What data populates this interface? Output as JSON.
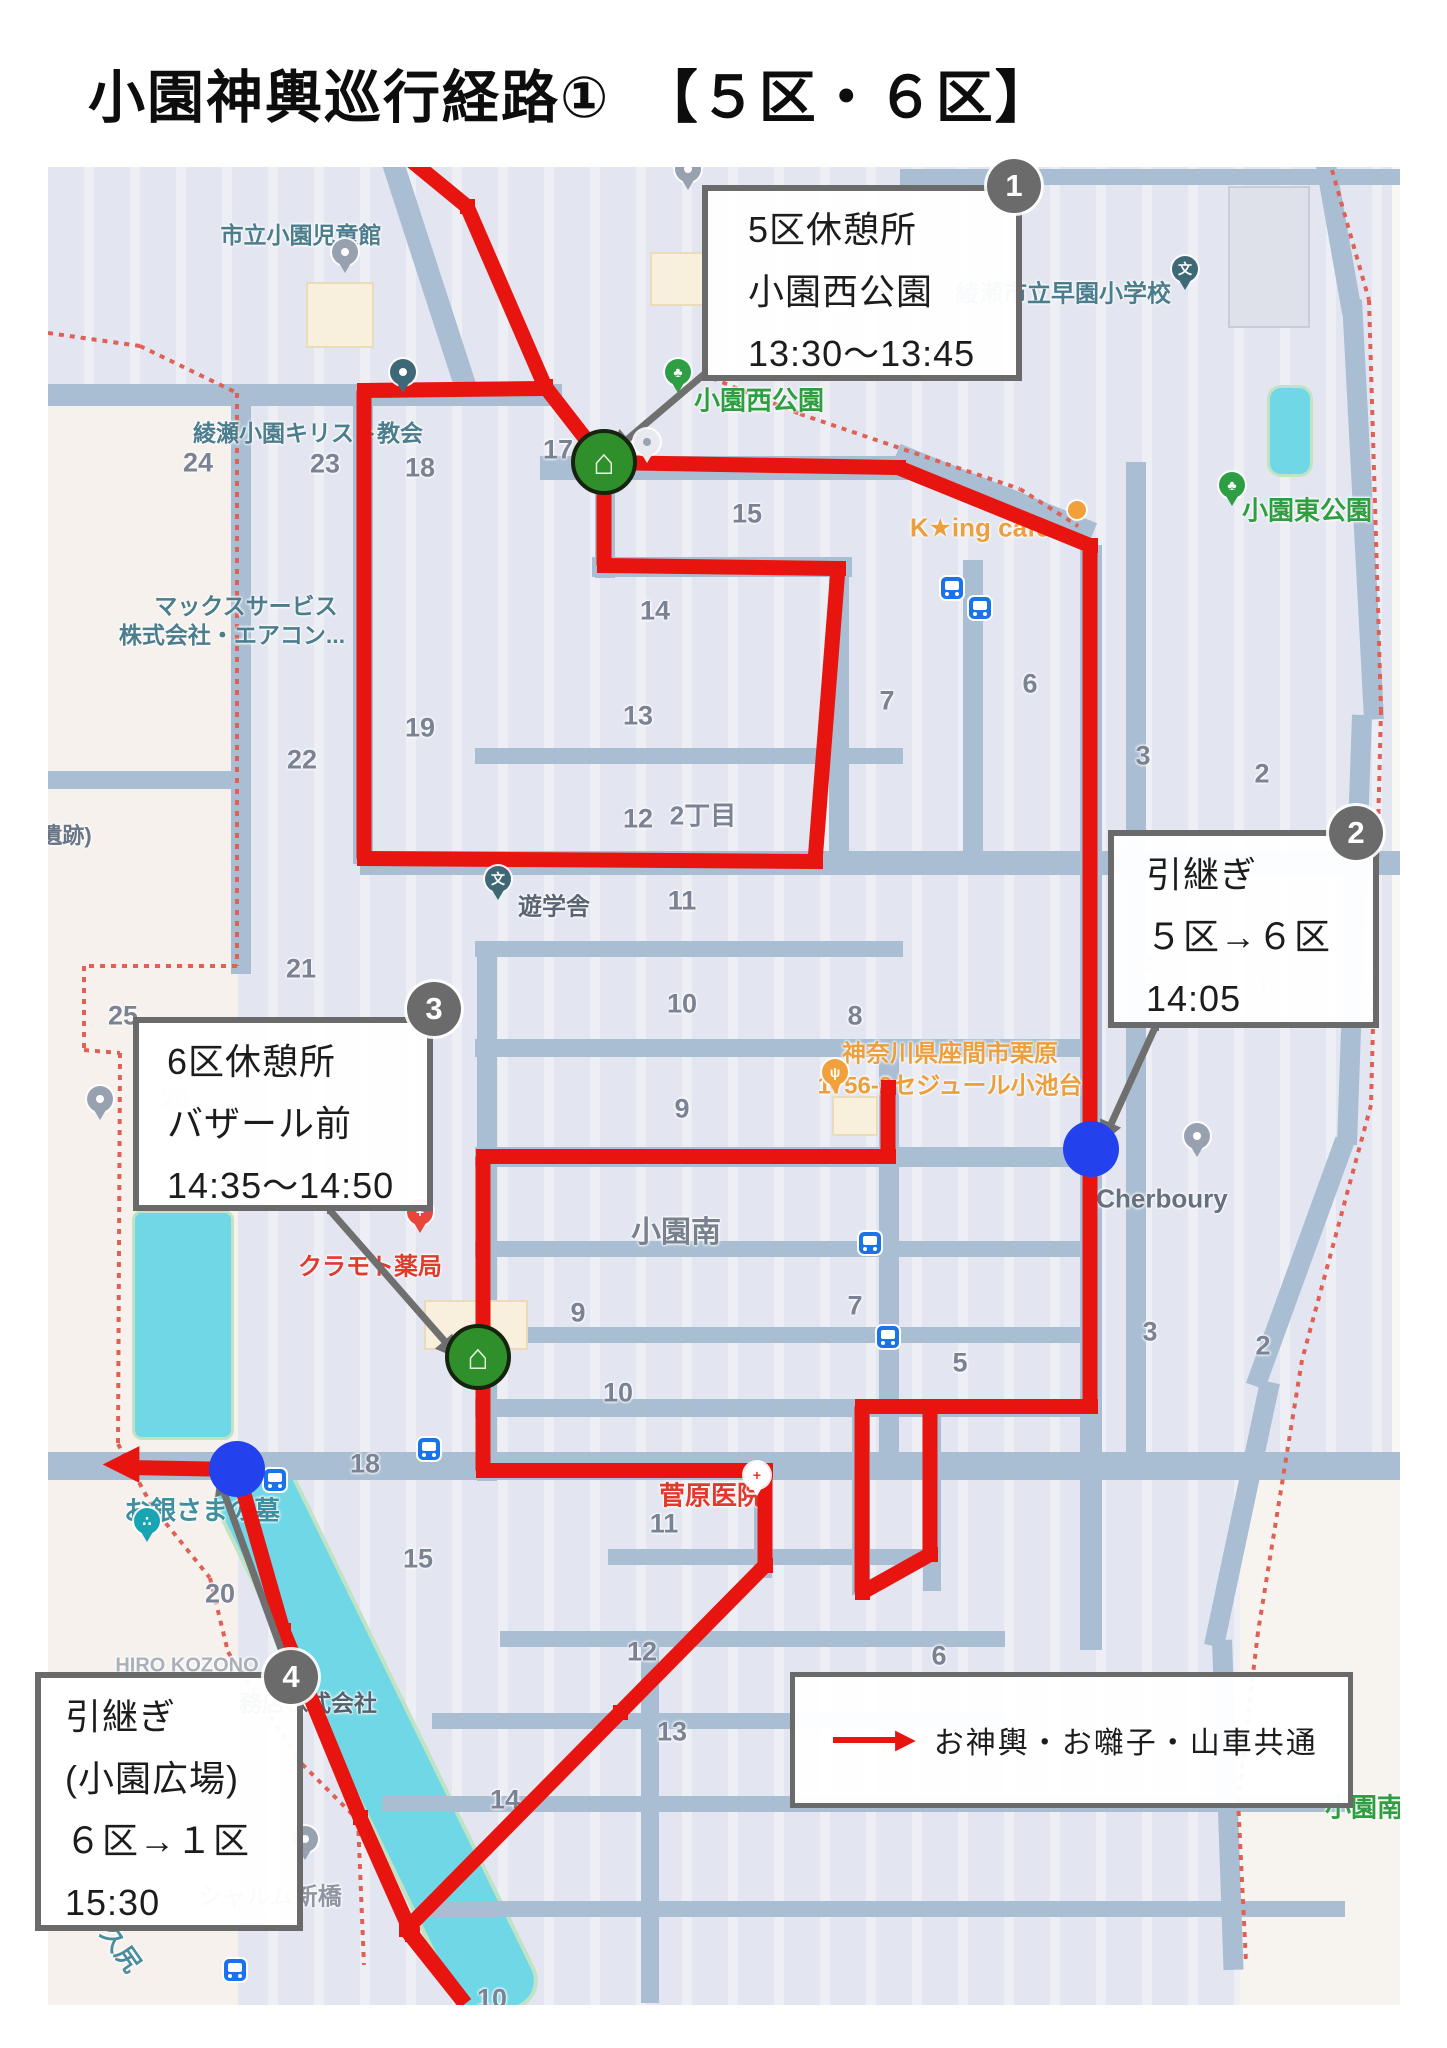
{
  "title": "小園神輿巡行経路①　【５区・６区】",
  "legend": {
    "x": 790,
    "y": 1672,
    "w": 553,
    "h": 126,
    "label": "お神輿・お囃子・山車共通",
    "arrow_color": "#e8140f"
  },
  "colors": {
    "route": "#e8140f",
    "road": "#a9bed3",
    "water": "#6fd7e6",
    "leader": "#6f6f6f",
    "badge": "#6b6b6b",
    "dot": "#2342ee",
    "house": "#2f8f2b",
    "boundary": "#e06055"
  },
  "info_boxes": [
    {
      "badge": "1",
      "x": 702,
      "y": 185,
      "w": 320,
      "h": 196,
      "bx": 1014,
      "by": 186,
      "pad": 40,
      "lines": [
        "5区休憩所",
        "小園西公園",
        "13:30〜13:45"
      ]
    },
    {
      "badge": "2",
      "x": 1108,
      "y": 830,
      "w": 271,
      "h": 198,
      "bx": 1356,
      "by": 833,
      "pad": 32,
      "lines": [
        "引継ぎ",
        "５区→６区",
        "14:05"
      ]
    },
    {
      "badge": "3",
      "x": 133,
      "y": 1017,
      "w": 300,
      "h": 194,
      "bx": 434,
      "by": 1009,
      "pad": 28,
      "lines": [
        "6区休憩所",
        "バザール前",
        "14:35〜14:50"
      ]
    },
    {
      "badge": "4",
      "x": 35,
      "y": 1672,
      "w": 268,
      "h": 259,
      "bx": 291,
      "by": 1677,
      "pad": 24,
      "lines": [
        "引継ぎ",
        "(小園広場)",
        "６区→１区",
        "15:30"
      ]
    }
  ],
  "map": {
    "x": 48,
    "y": 167,
    "w": 1352,
    "h": 1838
  },
  "tints": [
    {
      "x": 48,
      "y": 395,
      "w": 190,
      "h": 1610,
      "c": "#f6f1ed"
    },
    {
      "x": 1392,
      "y": 167,
      "w": 55,
      "h": 1295,
      "c": "#f9f7f4"
    },
    {
      "x": 1240,
      "y": 1462,
      "w": 207,
      "h": 543,
      "c": "#f7f4f0"
    }
  ],
  "water": [
    {
      "x": 132,
      "y": 1210,
      "w": 96,
      "h": 224,
      "r": 10
    },
    {
      "x": 1267,
      "y": 385,
      "w": 40,
      "h": 86,
      "r": 14
    }
  ],
  "river": {
    "x": 372,
    "y": 1736,
    "len": 600,
    "w": 78,
    "deg": 64
  },
  "roads_h": [
    [
      48,
      384,
      514,
      22
    ],
    [
      540,
      456,
      372,
      24
    ],
    [
      592,
      557,
      260,
      20
    ],
    [
      475,
      748,
      428,
      16
    ],
    [
      360,
      851,
      1087,
      24
    ],
    [
      475,
      941,
      428,
      16
    ],
    [
      475,
      1039,
      622,
      18
    ],
    [
      475,
      1147,
      622,
      20
    ],
    [
      475,
      1241,
      622,
      16
    ],
    [
      475,
      1327,
      622,
      16
    ],
    [
      475,
      1399,
      622,
      18
    ],
    [
      48,
      1452,
      1352,
      28
    ],
    [
      608,
      1549,
      330,
      16
    ],
    [
      500,
      1631,
      505,
      16
    ],
    [
      432,
      1713,
      573,
      16
    ],
    [
      382,
      1796,
      963,
      16
    ],
    [
      420,
      1901,
      925,
      16
    ],
    [
      48,
      771,
      190,
      18
    ],
    [
      900,
      169,
      500,
      16
    ]
  ],
  "roads_v": [
    [
      353,
      384,
      20,
      480
    ],
    [
      595,
      432,
      20,
      146
    ],
    [
      829,
      557,
      20,
      312
    ],
    [
      963,
      560,
      20,
      300
    ],
    [
      1080,
      545,
      22,
      1105
    ],
    [
      477,
      941,
      20,
      540
    ],
    [
      879,
      1041,
      20,
      412
    ],
    [
      852,
      1399,
      18,
      196
    ],
    [
      923,
      1399,
      18,
      192
    ],
    [
      754,
      1462,
      18,
      116
    ],
    [
      1126,
      462,
      20,
      1000
    ],
    [
      231,
      384,
      20,
      590
    ],
    [
      641,
      1631,
      18,
      372
    ]
  ],
  "roads_diag": [
    {
      "x": 388,
      "y": 148,
      "len": 260,
      "w": 22,
      "deg": 72
    },
    {
      "x": 896,
      "y": 455,
      "len": 212,
      "w": 24,
      "deg": 22
    },
    {
      "x": 1326,
      "y": 165,
      "len": 150,
      "w": 20,
      "deg": 80
    },
    {
      "x": 1352,
      "y": 300,
      "len": 420,
      "w": 20,
      "deg": 87
    },
    {
      "x": 1362,
      "y": 715,
      "len": 430,
      "w": 20,
      "deg": 92
    },
    {
      "x": 1345,
      "y": 1140,
      "len": 262,
      "w": 20,
      "deg": 110
    },
    {
      "x": 1270,
      "y": 1382,
      "len": 270,
      "w": 20,
      "deg": 102
    },
    {
      "x": 1222,
      "y": 1640,
      "len": 330,
      "w": 20,
      "deg": 88
    }
  ],
  "buildings": [
    {
      "x": 306,
      "y": 282,
      "w": 64,
      "h": 62,
      "c": "#f8efdc",
      "b": "#eadcb9"
    },
    {
      "x": 650,
      "y": 252,
      "w": 54,
      "h": 50,
      "c": "#f8efdc",
      "b": "#eadcb9"
    },
    {
      "x": 424,
      "y": 1300,
      "w": 100,
      "h": 46,
      "c": "#f8efdc",
      "b": "#eadcb9"
    },
    {
      "x": 832,
      "y": 1096,
      "w": 42,
      "h": 36,
      "c": "#f8efdc",
      "b": "#eadcb9"
    },
    {
      "x": 1228,
      "y": 186,
      "w": 78,
      "h": 138,
      "c": "#dfe1ea",
      "b": "#c9cdda"
    }
  ],
  "boundary": [
    [
      [
        48,
        333
      ],
      [
        140,
        346
      ],
      [
        237,
        393
      ],
      [
        237,
        966
      ],
      [
        84,
        966
      ],
      [
        84,
        1050
      ],
      [
        120,
        1053
      ],
      [
        118,
        1444
      ],
      [
        152,
        1506
      ],
      [
        210,
        1578
      ],
      [
        228,
        1652
      ],
      [
        302,
        1764
      ],
      [
        358,
        1820
      ],
      [
        364,
        1965
      ]
    ],
    [
      [
        702,
        374
      ],
      [
        800,
        414
      ],
      [
        1020,
        489
      ],
      [
        1078,
        526
      ]
    ],
    [
      [
        1332,
        170
      ],
      [
        1369,
        300
      ],
      [
        1381,
        710
      ],
      [
        1371,
        1105
      ],
      [
        1302,
        1360
      ],
      [
        1258,
        1632
      ],
      [
        1238,
        1800
      ],
      [
        1246,
        1962
      ]
    ]
  ],
  "route": [
    [
      [
        405,
        155
      ],
      [
        467,
        206
      ],
      [
        545,
        386
      ],
      [
        604,
        462
      ]
    ],
    [
      [
        604,
        462
      ],
      [
        898,
        467
      ],
      [
        1090,
        545
      ],
      [
        1090,
        1406
      ]
    ],
    [
      [
        1090,
        1406
      ],
      [
        862,
        1406
      ],
      [
        862,
        1592
      ],
      [
        930,
        1554
      ],
      [
        930,
        1406
      ]
    ],
    [
      [
        545,
        388
      ],
      [
        364,
        390
      ],
      [
        364,
        858
      ],
      [
        815,
        861
      ],
      [
        838,
        568
      ],
      [
        604,
        565
      ],
      [
        604,
        462
      ]
    ],
    [
      [
        888,
        1087
      ],
      [
        888,
        1156
      ],
      [
        483,
        1156
      ],
      [
        483,
        1470
      ],
      [
        765,
        1470
      ],
      [
        765,
        1565
      ],
      [
        620,
        1712
      ],
      [
        406,
        1929
      ],
      [
        465,
        2003
      ]
    ],
    [
      [
        237,
        1469
      ],
      [
        283,
        1630
      ],
      [
        360,
        1817
      ],
      [
        412,
        1934
      ],
      [
        465,
        2003
      ]
    ],
    [
      [
        237,
        1469
      ],
      [
        128,
        1467
      ]
    ]
  ],
  "route_heads": [
    {
      "x": 121,
      "y": 1467,
      "deg": 180,
      "size": 48
    }
  ],
  "leaders": [
    {
      "pts": [
        [
          705,
          373
        ],
        [
          626,
          440
        ]
      ],
      "head": {
        "x": 619,
        "y": 446,
        "deg": 140
      }
    },
    {
      "pts": [
        [
          1155,
          1027
        ],
        [
          1110,
          1126
        ]
      ],
      "head": {
        "x": 1107,
        "y": 1134,
        "deg": 114
      }
    },
    {
      "pts": [
        [
          330,
          1210
        ],
        [
          445,
          1341
        ]
      ],
      "head": {
        "x": 452,
        "y": 1349,
        "deg": 49
      }
    },
    {
      "pts": [
        [
          286,
          1662
        ],
        [
          224,
          1492
        ]
      ],
      "head": {
        "x": 221,
        "y": 1483,
        "deg": 250
      }
    }
  ],
  "houses": [
    {
      "x": 604,
      "y": 462
    },
    {
      "x": 478,
      "y": 1357
    }
  ],
  "handover_dots": [
    {
      "x": 1091,
      "y": 1149
    },
    {
      "x": 237,
      "y": 1469
    }
  ],
  "labels": [
    {
      "t": "市立小園児童館",
      "x": 301,
      "y": 233,
      "c": "#4b7d8d",
      "s": 23,
      "w": 700
    },
    {
      "t": "綾瀬小園キリスト教会",
      "x": 308,
      "y": 431,
      "c": "#4b7d8d",
      "s": 23,
      "w": 700
    },
    {
      "t": "マックスサービス",
      "x": 246,
      "y": 604,
      "c": "#4b7d8d",
      "s": 23,
      "w": 700
    },
    {
      "t": "株式会社・エアコン...",
      "x": 232,
      "y": 633,
      "c": "#4b7d8d",
      "s": 23,
      "w": 700
    },
    {
      "t": "お銀さまの墓",
      "x": 202,
      "y": 1509,
      "c": "#3e8fa0",
      "s": 26,
      "w": 700
    },
    {
      "t": "久尻",
      "x": 122,
      "y": 1948,
      "c": "#4b8d9d",
      "s": 25,
      "w": 700,
      "r": 55
    },
    {
      "t": "綾瀬市立早園小学校",
      "x": 1063,
      "y": 291,
      "c": "#4b7d8d",
      "s": 24,
      "w": 700
    },
    {
      "t": "遺跡)",
      "x": 66,
      "y": 834,
      "c": "#6a7685",
      "s": 22,
      "w": 700
    },
    {
      "t": "遊学舎",
      "x": 554,
      "y": 904,
      "c": "#5b6472",
      "s": 24,
      "w": 700
    },
    {
      "t": "Cherboury",
      "x": 1162,
      "y": 1199,
      "c": "#66707f",
      "s": 26,
      "w": 700
    },
    {
      "t": "シャルム新橋",
      "x": 270,
      "y": 1894,
      "c": "#8f96a1",
      "s": 24,
      "w": 700
    },
    {
      "t": "務店株式会社",
      "x": 308,
      "y": 1701,
      "c": "#555f6e",
      "s": 23,
      "w": 700
    },
    {
      "t": "HIRO KOZONO",
      "x": 187,
      "y": 1666,
      "c": "#aab0ba",
      "s": 20,
      "w": 700
    },
    {
      "t": "小園南",
      "x": 676,
      "y": 1229,
      "c": "#79818f",
      "s": 30,
      "w": 700
    },
    {
      "t": "24",
      "x": 198,
      "y": 463,
      "c": "#7b8294",
      "s": 27,
      "w": 700
    },
    {
      "t": "23",
      "x": 325,
      "y": 464,
      "c": "#7b8294",
      "s": 27,
      "w": 700
    },
    {
      "t": "18",
      "x": 420,
      "y": 468,
      "c": "#7b8294",
      "s": 27,
      "w": 700
    },
    {
      "t": "17",
      "x": 558,
      "y": 450,
      "c": "#7b8294",
      "s": 27,
      "w": 700
    },
    {
      "t": "15",
      "x": 747,
      "y": 514,
      "c": "#7b8294",
      "s": 27,
      "w": 700
    },
    {
      "t": "14",
      "x": 655,
      "y": 611,
      "c": "#7b8294",
      "s": 27,
      "w": 700
    },
    {
      "t": "13",
      "x": 638,
      "y": 716,
      "c": "#7b8294",
      "s": 27,
      "w": 700
    },
    {
      "t": "12",
      "x": 638,
      "y": 819,
      "c": "#7b8294",
      "s": 27,
      "w": 700
    },
    {
      "t": "2丁目",
      "x": 703,
      "y": 814,
      "c": "#7b8294",
      "s": 26,
      "w": 700
    },
    {
      "t": "11",
      "x": 682,
      "y": 901,
      "c": "#7b8294",
      "s": 27,
      "w": 700
    },
    {
      "t": "10",
      "x": 682,
      "y": 1004,
      "c": "#7b8294",
      "s": 27,
      "w": 700
    },
    {
      "t": "9",
      "x": 682,
      "y": 1109,
      "c": "#7b8294",
      "s": 27,
      "w": 700
    },
    {
      "t": "19",
      "x": 420,
      "y": 728,
      "c": "#7b8294",
      "s": 27,
      "w": 700
    },
    {
      "t": "22",
      "x": 302,
      "y": 760,
      "c": "#7b8294",
      "s": 27,
      "w": 700
    },
    {
      "t": "21",
      "x": 301,
      "y": 969,
      "c": "#7b8294",
      "s": 27,
      "w": 700
    },
    {
      "t": "25",
      "x": 123,
      "y": 1016,
      "c": "#7b8294",
      "s": 27,
      "w": 700
    },
    {
      "t": "7",
      "x": 887,
      "y": 701,
      "c": "#7b8294",
      "s": 27,
      "w": 700
    },
    {
      "t": "6",
      "x": 1030,
      "y": 684,
      "c": "#7b8294",
      "s": 27,
      "w": 700
    },
    {
      "t": "3",
      "x": 1143,
      "y": 756,
      "c": "#7b8294",
      "s": 27,
      "w": 700
    },
    {
      "t": "2",
      "x": 1262,
      "y": 774,
      "c": "#7b8294",
      "s": 27,
      "w": 700
    },
    {
      "t": "8",
      "x": 855,
      "y": 1016,
      "c": "#7b8294",
      "s": 27,
      "w": 700
    },
    {
      "t": "9",
      "x": 578,
      "y": 1313,
      "c": "#7b8294",
      "s": 27,
      "w": 700
    },
    {
      "t": "10",
      "x": 618,
      "y": 1393,
      "c": "#7b8294",
      "s": 27,
      "w": 700
    },
    {
      "t": "7",
      "x": 855,
      "y": 1306,
      "c": "#7b8294",
      "s": 27,
      "w": 700
    },
    {
      "t": "5",
      "x": 960,
      "y": 1363,
      "c": "#7b8294",
      "s": 27,
      "w": 700
    },
    {
      "t": "2",
      "x": 1263,
      "y": 1346,
      "c": "#7b8294",
      "s": 27,
      "w": 700
    },
    {
      "t": "3",
      "x": 1150,
      "y": 1332,
      "c": "#7b8294",
      "s": 27,
      "w": 700
    },
    {
      "t": "6",
      "x": 939,
      "y": 1656,
      "c": "#7b8294",
      "s": 27,
      "w": 700
    },
    {
      "t": "11",
      "x": 664,
      "y": 1524,
      "c": "#7b8294",
      "s": 27,
      "w": 700
    },
    {
      "t": "12",
      "x": 642,
      "y": 1652,
      "c": "#7b8294",
      "s": 27,
      "w": 700
    },
    {
      "t": "13",
      "x": 672,
      "y": 1732,
      "c": "#7b8294",
      "s": 27,
      "w": 700
    },
    {
      "t": "14",
      "x": 505,
      "y": 1800,
      "c": "#7b8294",
      "s": 27,
      "w": 700
    },
    {
      "t": "15",
      "x": 418,
      "y": 1559,
      "c": "#7b8294",
      "s": 27,
      "w": 700
    },
    {
      "t": "20",
      "x": 220,
      "y": 1594,
      "c": "#7b8294",
      "s": 27,
      "w": 700
    },
    {
      "t": "18",
      "x": 365,
      "y": 1464,
      "c": "#7b8294",
      "s": 27,
      "w": 700
    },
    {
      "t": "10",
      "x": 492,
      "y": 1999,
      "c": "#7b8294",
      "s": 27,
      "w": 700
    },
    {
      "t": "4",
      "x": 1147,
      "y": 966,
      "c": "#bcc2cc",
      "s": 26,
      "w": 700
    },
    {
      "t": "1",
      "x": 1263,
      "y": 986,
      "c": "#bcc2cc",
      "s": 26,
      "w": 700
    },
    {
      "t": "26",
      "x": 175,
      "y": 1100,
      "c": "#c6cbd4",
      "s": 26,
      "w": 700
    },
    {
      "t": "小園西公園",
      "x": 759,
      "y": 399,
      "c": "#2f9e41",
      "s": 26,
      "w": 700
    },
    {
      "t": "小園東公園",
      "x": 1307,
      "y": 509,
      "c": "#2f9e41",
      "s": 26,
      "w": 700
    },
    {
      "t": "小園南公園",
      "x": 1390,
      "y": 1806,
      "c": "#2f9e41",
      "s": 26,
      "w": 700
    },
    {
      "t": "K★ing cafe",
      "x": 980,
      "y": 528,
      "c": "#ec9f3c",
      "s": 26,
      "w": 700
    },
    {
      "t": "神奈川県座間市栗原",
      "x": 950,
      "y": 1051,
      "c": "#ec9f3c",
      "s": 24,
      "w": 700
    },
    {
      "t": "1756-2セジュール小池台",
      "x": 950,
      "y": 1083,
      "c": "#ec9f3c",
      "s": 24,
      "w": 700
    },
    {
      "t": "クラモト薬局",
      "x": 370,
      "y": 1264,
      "c": "#e03a2f",
      "s": 24,
      "w": 700
    },
    {
      "t": "菅原医院",
      "x": 711,
      "y": 1494,
      "c": "#e03a2f",
      "s": 26,
      "w": 700
    }
  ],
  "pins": [
    {
      "x": 345,
      "y": 273,
      "c": "#98a1b0",
      "g": "",
      "n": "place-pin"
    },
    {
      "x": 688,
      "y": 190,
      "c": "#98a1b0",
      "g": "",
      "n": "place-pin"
    },
    {
      "x": 100,
      "y": 1120,
      "c": "#98a1b0",
      "g": "",
      "n": "place-pin"
    },
    {
      "x": 1197,
      "y": 1157,
      "c": "#98a1b0",
      "g": "",
      "n": "place-pin"
    },
    {
      "x": 305,
      "y": 1860,
      "c": "#98a1b0",
      "g": "",
      "n": "place-pin"
    },
    {
      "x": 647,
      "y": 463,
      "c": "#e8eaf0",
      "g": "",
      "n": "place-pin"
    },
    {
      "x": 403,
      "y": 393,
      "c": "#3f6877",
      "g": "",
      "n": "church-pin"
    },
    {
      "x": 1185,
      "y": 290,
      "c": "#3f6877",
      "g": "文",
      "n": "school-pin"
    },
    {
      "x": 498,
      "y": 900,
      "c": "#3f6877",
      "g": "文",
      "n": "school-pin"
    },
    {
      "x": 147,
      "y": 1542,
      "c": "#19a4b4",
      "g": "∴",
      "n": "grave-pin"
    },
    {
      "x": 678,
      "y": 393,
      "c": "#2e9e44",
      "g": "♣",
      "n": "park-pin"
    },
    {
      "x": 1232,
      "y": 506,
      "c": "#2e9e44",
      "g": "♣",
      "n": "park-pin"
    },
    {
      "x": 835,
      "y": 1093,
      "c": "#f0a13c",
      "g": "ψ",
      "n": "restaurant-pin"
    },
    {
      "x": 420,
      "y": 1233,
      "c": "#e8453c",
      "g": "+",
      "n": "pharmacy-pin"
    },
    {
      "x": 757,
      "y": 1496,
      "c": "#ffffff",
      "g": "+",
      "gc": "#e03a2f",
      "n": "hospital-pin"
    },
    {
      "x": 1077,
      "y": 519,
      "c": "#f0a13c",
      "g": "",
      "n": "cafe-pin"
    }
  ],
  "bus_stops": [
    {
      "x": 952,
      "y": 588
    },
    {
      "x": 980,
      "y": 608
    },
    {
      "x": 870,
      "y": 1243
    },
    {
      "x": 888,
      "y": 1337
    },
    {
      "x": 429,
      "y": 1449
    },
    {
      "x": 275,
      "y": 1480
    },
    {
      "x": 235,
      "y": 1970
    }
  ]
}
